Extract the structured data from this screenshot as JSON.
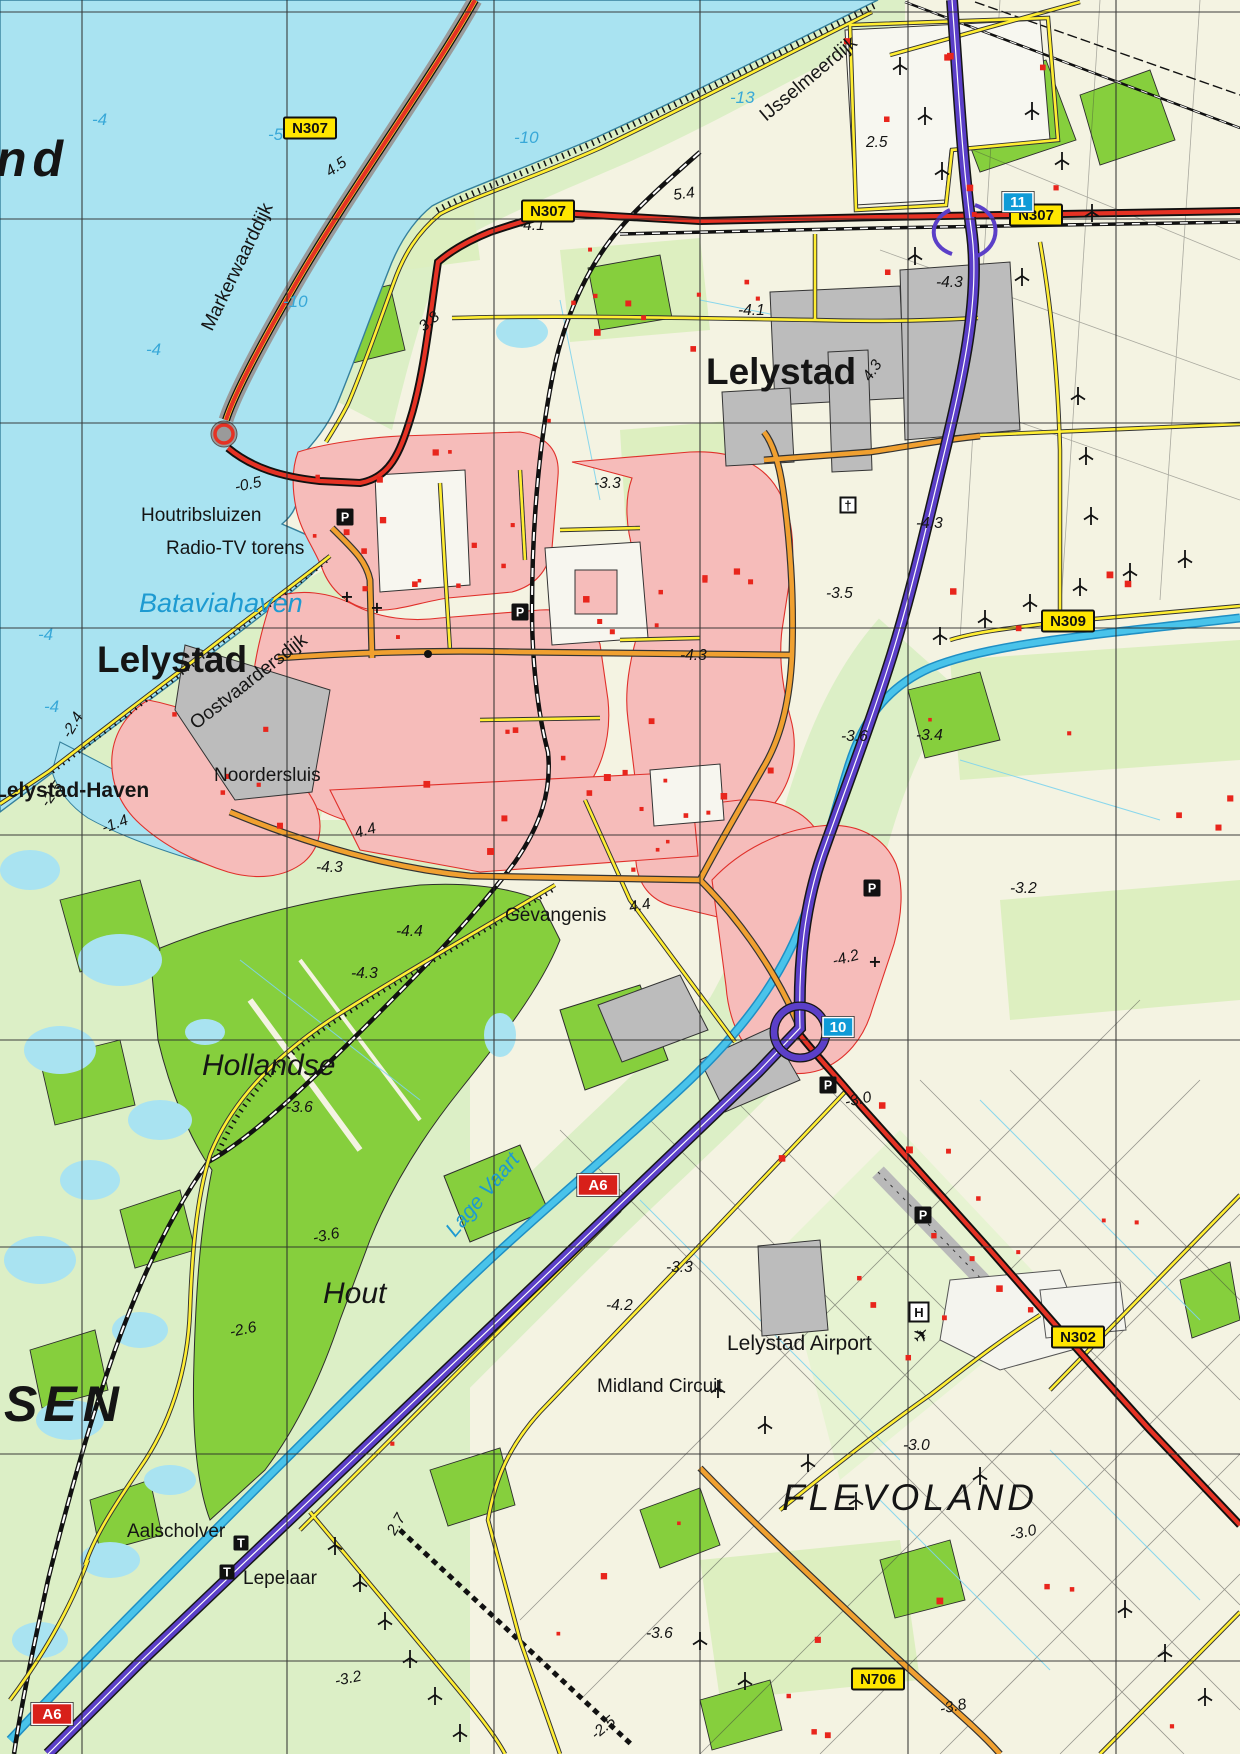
{
  "map": {
    "colors": {
      "water": "#a9e3f1",
      "marsh": "#dcefc6",
      "field": "#f4f3e2",
      "forest": "#86cf3d",
      "urban": "#f6bcba",
      "industrial": "#bcbcbc",
      "motorway": "#5b3fc8",
      "n_road": "#e53224",
      "local_road": "#f0a030",
      "minor_road": "#ffee33",
      "canal": "#49c3ea",
      "building": "#e8251c",
      "grid": "#2b2b2b",
      "badge_yellow": "#ffe600",
      "badge_red": "#d8201a",
      "badge_blue": "#0f9bd7"
    },
    "labels": [
      {
        "t": "Lelystad",
        "x": 97,
        "y": 672,
        "cls": "city"
      },
      {
        "t": "Lelystad",
        "x": 706,
        "y": 384,
        "cls": "city"
      },
      {
        "t": "Lelystad-Haven",
        "x": -6,
        "y": 797,
        "cls": "town"
      },
      {
        "t": "Houtribsluizen",
        "x": 141,
        "y": 521,
        "cls": "name"
      },
      {
        "t": "Radio-TV torens",
        "x": 166,
        "y": 554,
        "cls": "name"
      },
      {
        "t": "Noordersluis",
        "x": 214,
        "y": 781,
        "cls": "name"
      },
      {
        "t": "Gevangenis",
        "x": 505,
        "y": 921,
        "cls": "name"
      },
      {
        "t": "Aalscholver",
        "x": 127,
        "y": 1537,
        "cls": "name"
      },
      {
        "t": "Lepelaar",
        "x": 243,
        "y": 1584,
        "cls": "name"
      },
      {
        "t": "Midland Circuit",
        "x": 597,
        "y": 1392,
        "cls": "name"
      },
      {
        "t": "Lelystad Airport",
        "x": 727,
        "y": 1350,
        "cls": "name2"
      },
      {
        "t": "Hollandse",
        "x": 202,
        "y": 1075,
        "cls": "wood"
      },
      {
        "t": "Hout",
        "x": 323,
        "y": 1303,
        "cls": "wood"
      },
      {
        "t": "FLEVOLAND",
        "x": 782,
        "y": 1510,
        "cls": "region"
      },
      {
        "t": "SEN",
        "x": 4,
        "y": 1421,
        "cls": "huge"
      },
      {
        "t": "nd",
        "x": -4,
        "y": 176,
        "cls": "huge"
      },
      {
        "t": "Bataviahaven",
        "x": 139,
        "y": 612,
        "cls": "water"
      },
      {
        "t": "Lage Vaart",
        "x": 455,
        "y": 1238,
        "cls": "waterway",
        "rot": -50
      },
      {
        "t": "Oostvaardersdijk",
        "x": 196,
        "y": 730,
        "cls": "name",
        "rot": -38
      },
      {
        "t": "Markerwaarddijk",
        "x": 212,
        "y": 332,
        "cls": "name",
        "rot": -64
      },
      {
        "t": "IJsselmeerdijk",
        "x": 766,
        "y": 122,
        "cls": "name",
        "rot": -40
      },
      {
        "t": "-4",
        "x": 92,
        "y": 125,
        "cls": "depth"
      },
      {
        "t": "-5",
        "x": 268,
        "y": 140,
        "cls": "depth"
      },
      {
        "t": "-10",
        "x": 514,
        "y": 143,
        "cls": "depth"
      },
      {
        "t": "-13",
        "x": 730,
        "y": 103,
        "cls": "depth"
      },
      {
        "t": "-10",
        "x": 283,
        "y": 307,
        "cls": "depth"
      },
      {
        "t": "-4",
        "x": 146,
        "y": 355,
        "cls": "depth"
      },
      {
        "t": "-4",
        "x": 38,
        "y": 640,
        "cls": "depth"
      },
      {
        "t": "-4",
        "x": 44,
        "y": 712,
        "cls": "depth"
      },
      {
        "t": "4.5",
        "x": 330,
        "y": 177,
        "cls": "elev",
        "rot": -35
      },
      {
        "t": "-4.1",
        "x": 518,
        "y": 230,
        "cls": "elev"
      },
      {
        "t": "5.4",
        "x": 674,
        "y": 200,
        "cls": "elev",
        "rot": -8
      },
      {
        "t": "2.5",
        "x": 866,
        "y": 147,
        "cls": "elev"
      },
      {
        "t": "3.8",
        "x": 424,
        "y": 332,
        "cls": "elev",
        "rot": -40
      },
      {
        "t": "-4.3",
        "x": 936,
        "y": 287,
        "cls": "elev"
      },
      {
        "t": "4.3",
        "x": 870,
        "y": 382,
        "cls": "elev",
        "rot": -55
      },
      {
        "t": "-4.1",
        "x": 738,
        "y": 315,
        "cls": "elev"
      },
      {
        "t": "-3.3",
        "x": 594,
        "y": 488,
        "cls": "elev"
      },
      {
        "t": "-4.3",
        "x": 916,
        "y": 528,
        "cls": "elev"
      },
      {
        "t": "-3.5",
        "x": 826,
        "y": 598,
        "cls": "elev"
      },
      {
        "t": "-4.3",
        "x": 680,
        "y": 660,
        "cls": "elev"
      },
      {
        "t": "-3.6",
        "x": 841,
        "y": 741,
        "cls": "elev"
      },
      {
        "t": "-3.4",
        "x": 916,
        "y": 740,
        "cls": "elev"
      },
      {
        "t": "-3.2",
        "x": 1010,
        "y": 893,
        "cls": "elev"
      },
      {
        "t": "-4.2",
        "x": 834,
        "y": 966,
        "cls": "elev",
        "rot": -15
      },
      {
        "t": "-4.4",
        "x": 396,
        "y": 936,
        "cls": "elev"
      },
      {
        "t": "-4.3",
        "x": 351,
        "y": 978,
        "cls": "elev"
      },
      {
        "t": "4.4",
        "x": 356,
        "y": 838,
        "cls": "elev",
        "rot": -15
      },
      {
        "t": "-4.3",
        "x": 316,
        "y": 872,
        "cls": "elev"
      },
      {
        "t": "4.4",
        "x": 630,
        "y": 912,
        "cls": "elev",
        "rot": -10
      },
      {
        "t": "-1.4",
        "x": 104,
        "y": 833,
        "cls": "elev",
        "rot": -20
      },
      {
        "t": "-2.4",
        "x": 70,
        "y": 739,
        "cls": "elev",
        "rot": -60
      },
      {
        "t": "-2.5",
        "x": 48,
        "y": 808,
        "cls": "elev",
        "rot": -55
      },
      {
        "t": "-0.5",
        "x": 236,
        "y": 492,
        "cls": "elev",
        "rot": -12
      },
      {
        "t": "-3.3",
        "x": 666,
        "y": 1272,
        "cls": "elev"
      },
      {
        "t": "-4.2",
        "x": 606,
        "y": 1310,
        "cls": "elev"
      },
      {
        "t": "-3.6",
        "x": 286,
        "y": 1112,
        "cls": "elev"
      },
      {
        "t": "-3.6",
        "x": 314,
        "y": 1243,
        "cls": "elev",
        "rot": -12
      },
      {
        "t": "-2.6",
        "x": 231,
        "y": 1337,
        "cls": "elev",
        "rot": -12
      },
      {
        "t": "-3.0",
        "x": 846,
        "y": 1107,
        "cls": "elev",
        "rot": -12
      },
      {
        "t": "2.7",
        "x": 395,
        "y": 1536,
        "cls": "elev",
        "rot": -60
      },
      {
        "t": "-3.0",
        "x": 903,
        "y": 1450,
        "cls": "elev"
      },
      {
        "t": "-3.0",
        "x": 1011,
        "y": 1540,
        "cls": "elev",
        "rot": -12
      },
      {
        "t": "-3.6",
        "x": 646,
        "y": 1638,
        "cls": "elev"
      },
      {
        "t": "-3.2",
        "x": 336,
        "y": 1686,
        "cls": "elev",
        "rot": -12
      },
      {
        "t": "-3.8",
        "x": 941,
        "y": 1714,
        "cls": "elev",
        "rot": -12
      },
      {
        "t": "-2.5",
        "x": 596,
        "y": 1740,
        "cls": "elev",
        "rot": -40
      }
    ],
    "road_badges": [
      {
        "type": "n",
        "t": "N307",
        "x": 310,
        "y": 128
      },
      {
        "type": "n",
        "t": "N307",
        "x": 548,
        "y": 211
      },
      {
        "type": "n",
        "t": "N307",
        "x": 1036,
        "y": 215
      },
      {
        "type": "n",
        "t": "N309",
        "x": 1068,
        "y": 621
      },
      {
        "type": "n",
        "t": "N302",
        "x": 1078,
        "y": 1337
      },
      {
        "type": "n",
        "t": "N706",
        "x": 878,
        "y": 1679
      },
      {
        "type": "a",
        "t": "A6",
        "x": 598,
        "y": 1185
      },
      {
        "type": "a",
        "t": "A6",
        "x": 52,
        "y": 1714
      },
      {
        "type": "exit",
        "t": "11",
        "x": 1018,
        "y": 202
      },
      {
        "type": "exit",
        "t": "10",
        "x": 838,
        "y": 1027
      }
    ],
    "symbols": [
      {
        "icon": "parking",
        "g": "P",
        "x": 345,
        "y": 517
      },
      {
        "icon": "parking",
        "g": "P",
        "x": 520,
        "y": 612
      },
      {
        "icon": "parking",
        "g": "P",
        "x": 872,
        "y": 888
      },
      {
        "icon": "parking",
        "g": "P",
        "x": 828,
        "y": 1085
      },
      {
        "icon": "parking",
        "g": "P",
        "x": 923,
        "y": 1215
      },
      {
        "icon": "h-badge",
        "g": "H",
        "x": 919,
        "y": 1312
      },
      {
        "icon": "tower",
        "g": "T",
        "x": 241,
        "y": 1543
      },
      {
        "icon": "tower",
        "g": "T",
        "x": 227,
        "y": 1572
      },
      {
        "icon": "church",
        "g": "†",
        "x": 848,
        "y": 505
      },
      {
        "icon": "airplane",
        "g": "✈",
        "x": 926,
        "y": 1340
      },
      {
        "icon": "crossroad",
        "g": "+",
        "x": 347,
        "y": 602
      },
      {
        "icon": "crossroad",
        "g": "+",
        "x": 377,
        "y": 613
      },
      {
        "icon": "crossroad",
        "g": "+",
        "x": 875,
        "y": 967
      },
      {
        "icon": "dot",
        "g": "●",
        "x": 428,
        "y": 654
      }
    ],
    "wind_turbines": [
      [
        900,
        65
      ],
      [
        925,
        115
      ],
      [
        942,
        170
      ],
      [
        915,
        255
      ],
      [
        1032,
        110
      ],
      [
        1062,
        160
      ],
      [
        1092,
        212
      ],
      [
        1022,
        276
      ],
      [
        940,
        635
      ],
      [
        985,
        618
      ],
      [
        1030,
        602
      ],
      [
        1080,
        586
      ],
      [
        1130,
        571
      ],
      [
        1185,
        558
      ],
      [
        1078,
        395
      ],
      [
        1086,
        455
      ],
      [
        1091,
        515
      ],
      [
        335,
        1545
      ],
      [
        360,
        1582
      ],
      [
        385,
        1620
      ],
      [
        410,
        1658
      ],
      [
        435,
        1695
      ],
      [
        460,
        1732
      ],
      [
        718,
        1388
      ],
      [
        765,
        1424
      ],
      [
        808,
        1462
      ],
      [
        856,
        1500
      ],
      [
        980,
        1475
      ],
      [
        1125,
        1608
      ],
      [
        1165,
        1652
      ],
      [
        1205,
        1696
      ],
      [
        700,
        1640
      ],
      [
        745,
        1680
      ]
    ]
  }
}
